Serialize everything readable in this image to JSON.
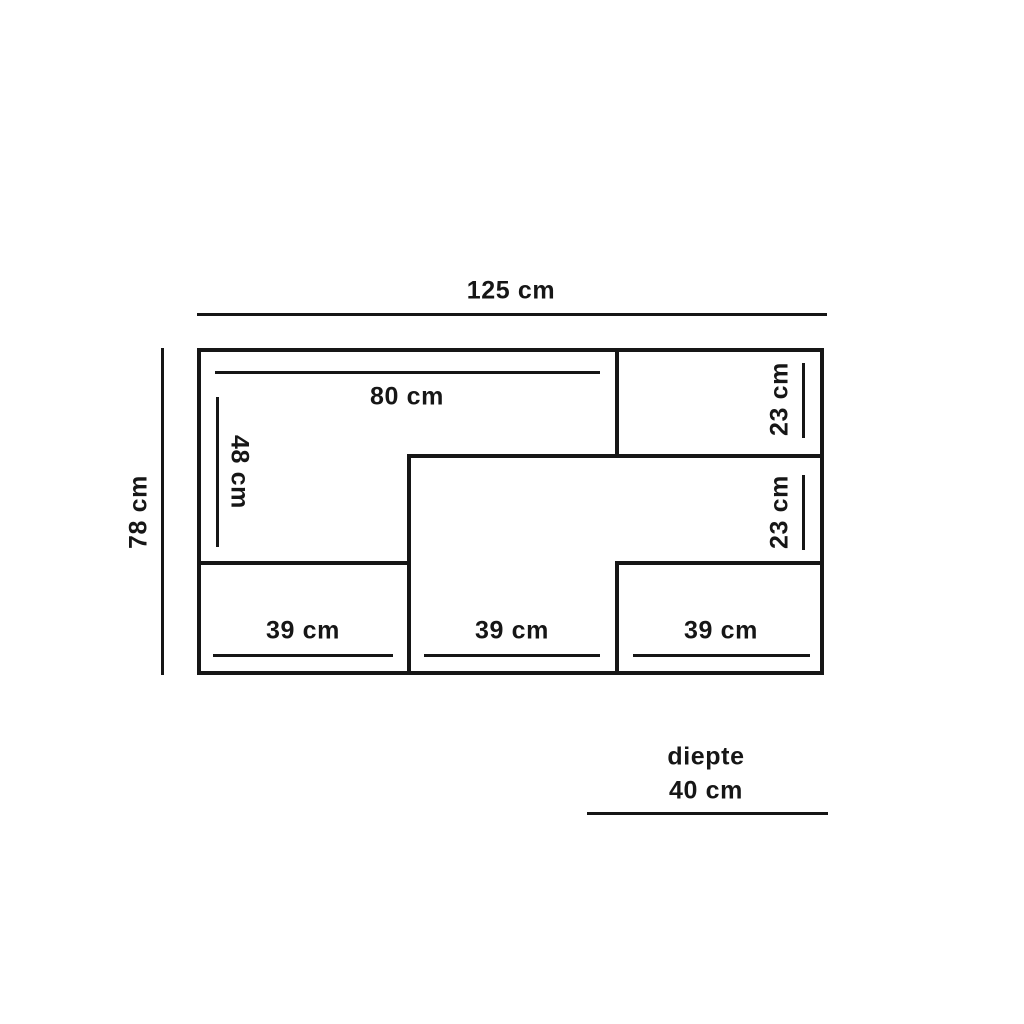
{
  "diagram": {
    "outer": {
      "width_label": "125 cm",
      "height_label": "78 cm"
    },
    "interior": {
      "top_shelf_width_label": "80 cm",
      "left_section_height_label": "48 cm",
      "right_top_section_height_label": "23 cm",
      "right_middle_section_height_label": "23 cm",
      "bottom_left_section_width_label": "39 cm",
      "bottom_middle_section_width_label": "39 cm",
      "bottom_right_section_width_label": "39 cm"
    },
    "depth": {
      "label": "diepte",
      "value_label": "40 cm"
    }
  },
  "colors": {
    "line": "#161616",
    "background": "#ffffff",
    "text": "#161616"
  }
}
